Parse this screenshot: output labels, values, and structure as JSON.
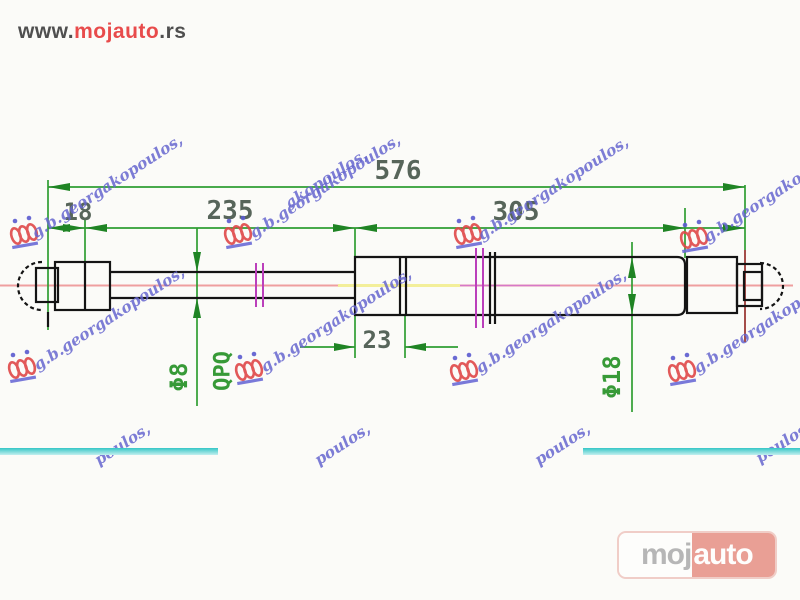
{
  "site": {
    "brand": {
      "prefix": "www.",
      "name": "mojauto",
      "tld": ".rs"
    }
  },
  "drawing": {
    "type": "gas-spring technical drawing",
    "dimensions": {
      "total_length": "576",
      "eye_offset": "18",
      "rod_length": "235",
      "body_length": "305",
      "piston_offset": "23",
      "rod_diameter": "Φ8",
      "surface_treatment": "QPQ",
      "body_diameter": "Φ18"
    },
    "colors": {
      "dimension_green": "#2f9e33",
      "outline_black": "#141414",
      "centerline_pink": "#ef9f9f",
      "break_magenta": "#bb3fbb",
      "extension_maroon": "#9c3a36",
      "highlight_cyan": "#8fdede"
    }
  },
  "watermark": {
    "text": "g.b.georgakopoulos,",
    "fragment_top": "akopoulos,",
    "fragment_bottom": "poulos,"
  },
  "badge": {
    "moj": "moj",
    "auto": "auto"
  }
}
